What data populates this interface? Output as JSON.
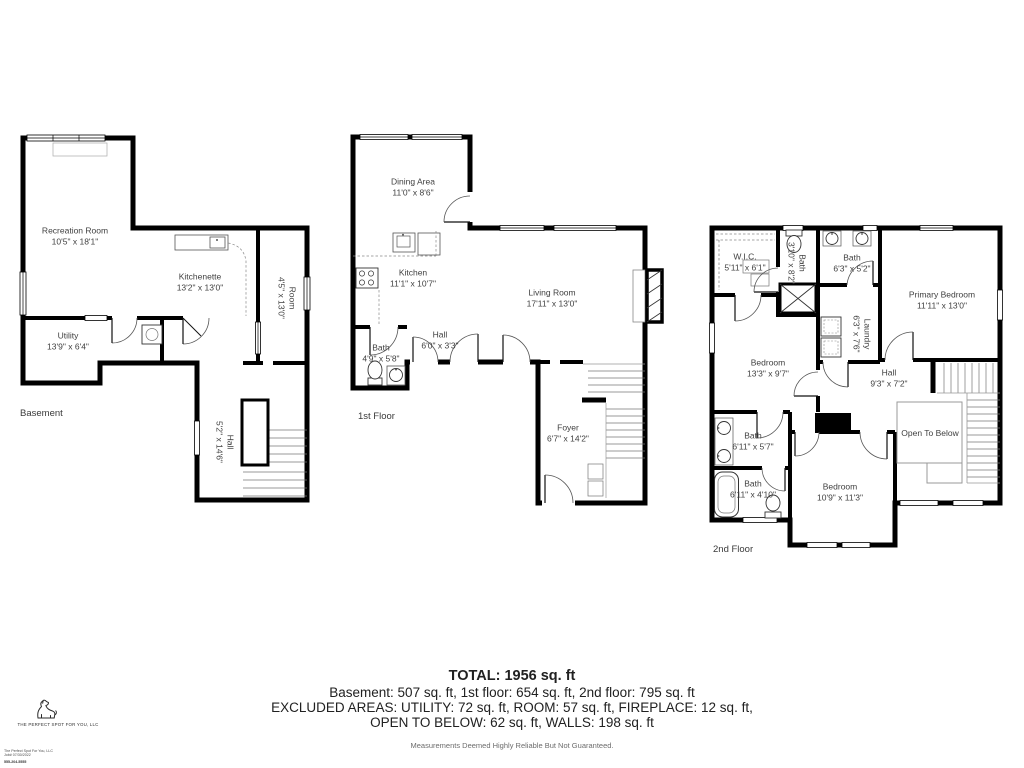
{
  "colors": {
    "wall": "#000000",
    "room_text": "#3f3f3f",
    "stair_line": "#777777",
    "background": "#ffffff"
  },
  "floors": [
    {
      "label": "Basement",
      "rooms": [
        {
          "name": "Recreation Room",
          "dims": "10'5\" x 18'1\""
        },
        {
          "name": "Kitchenette",
          "dims": "13'2\" x 13'0\""
        },
        {
          "name": "Room",
          "dims": "4'5\" x 13'0\""
        },
        {
          "name": "Utility",
          "dims": "13'9\" x 6'4\""
        },
        {
          "name": "Hall",
          "dims": "5'2\" x 14'6\""
        }
      ]
    },
    {
      "label": "1st Floor",
      "rooms": [
        {
          "name": "Dining Area",
          "dims": "11'0\" x 8'6\""
        },
        {
          "name": "Kitchen",
          "dims": "11'1\" x 10'7\""
        },
        {
          "name": "Living Room",
          "dims": "17'11\" x 13'0\""
        },
        {
          "name": "Hall",
          "dims": "6'0\" x 3'3\""
        },
        {
          "name": "Bath",
          "dims": "4'9\" x 5'8\""
        },
        {
          "name": "Foyer",
          "dims": "6'7\" x 14'2\""
        }
      ]
    },
    {
      "label": "2nd Floor",
      "rooms": [
        {
          "name": "W.I.C.",
          "dims": "5'11\" x 6'1\""
        },
        {
          "name": "Bath",
          "dims": "3'10\" x 8'2\""
        },
        {
          "name": "Bath",
          "dims": "6'3\" x 5'2\""
        },
        {
          "name": "Primary Bedroom",
          "dims": "11'11\" x 13'0\""
        },
        {
          "name": "Laundry",
          "dims": "6'3\" x 7'6\""
        },
        {
          "name": "Bedroom",
          "dims": "13'3\" x 9'7\""
        },
        {
          "name": "Hall",
          "dims": "9'3\" x 7'2\""
        },
        {
          "name": "Open To Below",
          "dims": ""
        },
        {
          "name": "Bath",
          "dims": "6'11\" x 5'7\""
        },
        {
          "name": "Bath",
          "dims": "6'11\" x 4'10\""
        },
        {
          "name": "Bedroom",
          "dims": "10'9\" x 11'3\""
        }
      ]
    }
  ],
  "summary": {
    "total": "TOTAL: 1956 sq. ft",
    "line2": "Basement: 507 sq. ft, 1st floor: 654 sq. ft, 2nd floor: 795 sq. ft",
    "line3": "EXCLUDED AREAS: UTILITY: 72 sq. ft, ROOM: 57 sq. ft, FIREPLACE: 12 sq. ft,",
    "line4": "OPEN TO BELOW: 62 sq. ft, WALLS: 198 sq. ft",
    "disclaimer": "Measurements Deemed Highly Reliable But Not Guaranteed."
  },
  "branding": {
    "company": "THE PERFECT SPOT FOR YOU, LLC",
    "fine_print": [
      "The Perfect Spot For You, LLC",
      "Job# 07/30/2022",
      "555-204-5555"
    ]
  }
}
